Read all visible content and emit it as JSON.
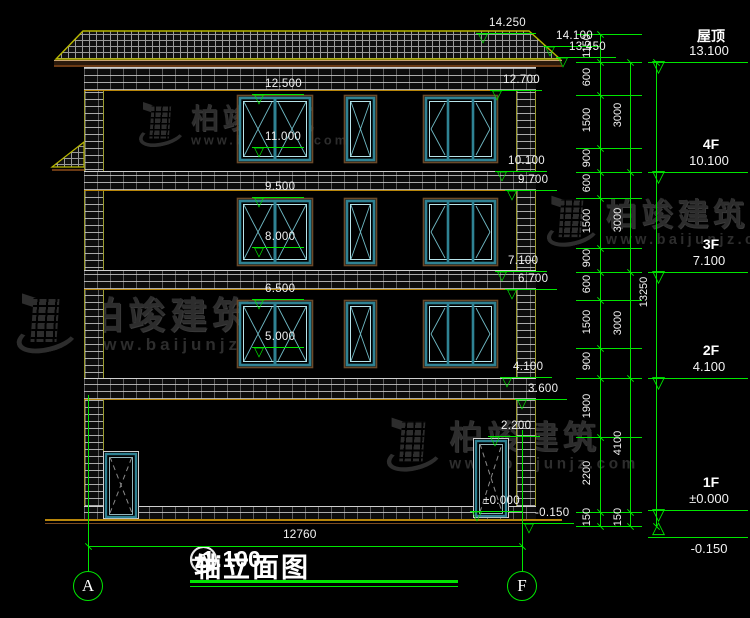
{
  "drawing": {
    "title": {
      "prefix_axis": "A",
      "dash": "—",
      "suffix_axis": "F",
      "text": "轴立面图",
      "scale": "1:100"
    },
    "axis_bubbles": [
      "A",
      "F"
    ],
    "bottom_dim": "12760",
    "watermark": {
      "brand": "柏竣建筑",
      "site": "www.baijunjz.com"
    },
    "right_panel": {
      "chain": [
        "1150",
        "600",
        "1500",
        "900",
        "600",
        "1500",
        "900",
        "600",
        "1500",
        "900",
        "1900",
        "2200",
        "150"
      ],
      "floors": [
        "3000",
        "3000",
        "3000",
        "4100",
        "150"
      ],
      "total": "13250",
      "levels": [
        {
          "label": "屋顶",
          "value": "13.100"
        },
        {
          "label": "4F",
          "value": "10.100"
        },
        {
          "label": "3F",
          "value": "7.100"
        },
        {
          "label": "2F",
          "value": "4.100"
        },
        {
          "label": "1F",
          "value": "±0.000"
        },
        {
          "label": "",
          "value": "-0.150"
        }
      ]
    },
    "markers": {
      "top": [
        "14.250",
        "14.100",
        "13.450"
      ],
      "left": [
        "12.500",
        "11.000",
        "9.500",
        "8.000",
        "6.500",
        "5.000"
      ],
      "right": [
        "12.700",
        "10.100",
        "9.700",
        "7.100",
        "6.700",
        "4.100",
        "3.600",
        "2.200",
        "±0.000",
        "-0.150"
      ]
    },
    "colors": {
      "green": "#00e600",
      "tan": "#b8860b",
      "brown": "#6b4a2a",
      "yellow": "#b8b800",
      "teal": "#2f8293",
      "teal_light": "#b8e4ea",
      "glaze": "#6fb9c4",
      "watermark": "#2d2d2d",
      "white": "#f0f0f0"
    }
  }
}
